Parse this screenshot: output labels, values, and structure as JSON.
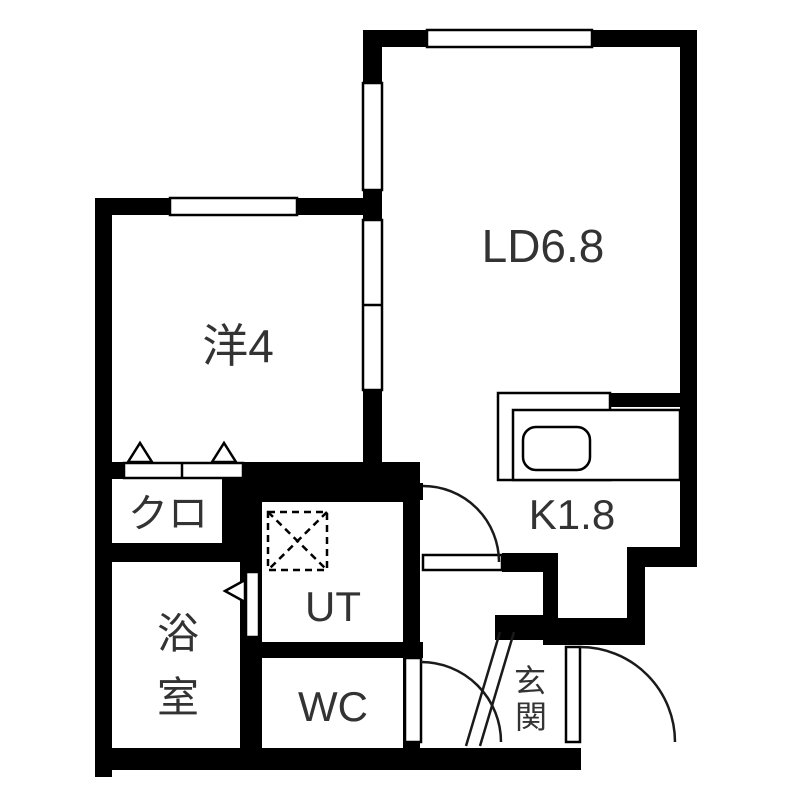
{
  "document": {
    "type": "japanese-apartment-floor-plan",
    "background_color": "#ffffff",
    "wall_color": "#000000",
    "label_color": "#333333"
  },
  "rooms": {
    "living_dining": {
      "label": "LD6.8",
      "name_ja": "リビングダイニング",
      "size_tatami": 6.8
    },
    "western_room": {
      "label": "洋4",
      "name_ja": "洋室",
      "size_tatami": 4
    },
    "closet": {
      "label": "クロ",
      "name_ja": "クローゼット"
    },
    "bathroom": {
      "label": "浴室",
      "char1": "浴",
      "char2": "室"
    },
    "utility": {
      "label": "UT",
      "name_ja": "ユーティリティ"
    },
    "toilet": {
      "label": "WC"
    },
    "kitchen": {
      "label": "K1.8",
      "name_ja": "キッチン",
      "size_tatami": 1.8
    },
    "entrance": {
      "label": "玄関",
      "char1": "玄",
      "char2": "関"
    }
  },
  "fixtures": {
    "kitchen_sink": "sink-counter",
    "washing_machine_space": "dashed-square-with-x",
    "windows": 3,
    "hinged_door_arcs": 3,
    "sliding_partition_panels": 2,
    "bifold_closet_triangles": 2,
    "bathroom_door_marker": "left-pointing-triangle"
  }
}
